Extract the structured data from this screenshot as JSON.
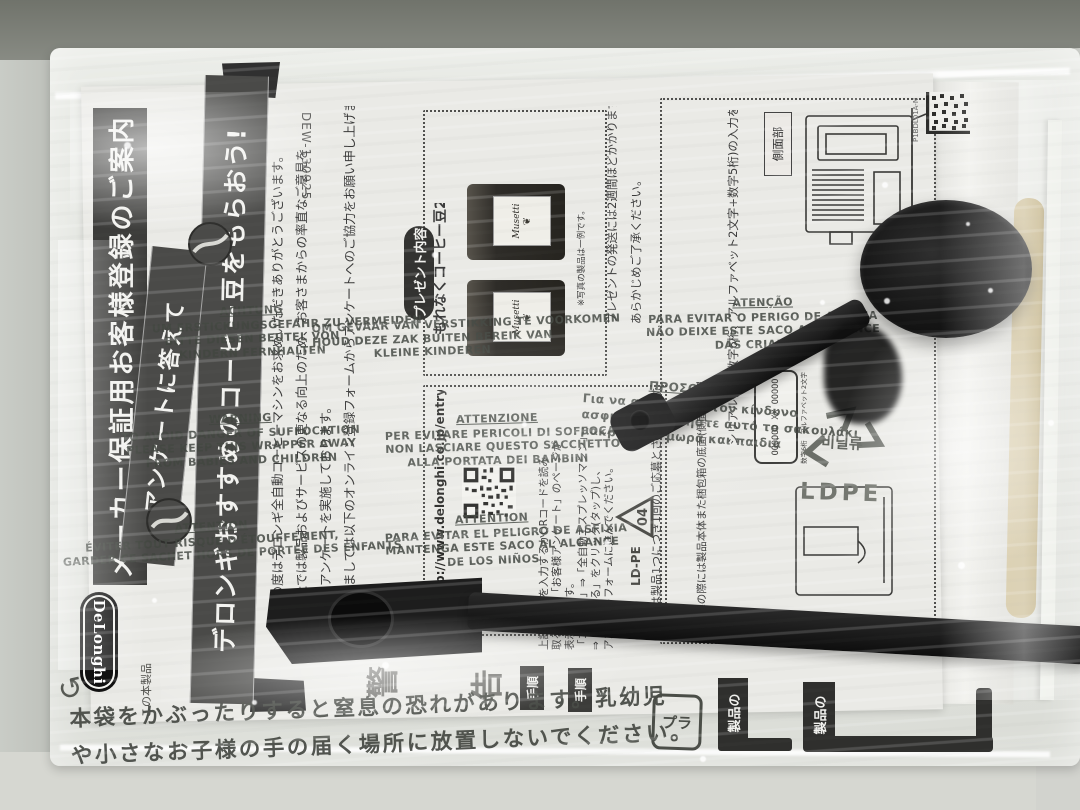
{
  "manual": {
    "title_banner": "メーカー保証用お客様登録のご案内",
    "doc_number": "DEW-130925",
    "ribbon_small": "アンケートに答えて",
    "ribbon_large": "デロンギおすすめのコーヒー豆をもらおう!",
    "logo": "DeLonghi",
    "print_code": "P1BDL01A-N",
    "intro_lines": [
      "この度はデロンギ全自動コーヒーマシンをお求めいただきありがとうございます。",
      "当社では製品およびサービスの更なる向上のため、お客さまからの率直なご意見を",
      "頂くアンケートを実施しております。",
      "つきましては以下のオンライン登録フォームからアンケートへのご協力をお願い申し上げます。"
    ],
    "campaign_note_lines": [
      "プレゼントの発送には2週間ほどかかりますので、",
      "あらかじめご了承ください。"
    ],
    "present": {
      "header": "プレゼント内容",
      "caption": "もれなくコーヒー豆2袋",
      "note": "※写真の製品は一例です。",
      "brand": "Musetti"
    },
    "entry": {
      "url": "http://www.delonghi.co.jp/entry",
      "instruction_lines": [
        "上記のURLを入力するかQRコードを読み",
        "取ることで「お客様アンケート」のページが",
        "表示されます。",
        "「コーヒー」⇒「全自動エスプレッソマシン」",
        "⇒「回答する」をクリック(タップ)し、",
        "アンケートフォームに進んでください。"
      ]
    },
    "serial": {
      "instruction": "シリアル番号(数字6桁、アルファベット2文字+数字5桁)の入力をお願いいたします。",
      "note1": "ご応募は製品1つにつき1回のご応募とさせていただきます。",
      "note2": "※応募の際には製品本体また梱包箱の底面(側面)に記載されている",
      "plate": "OOOOOO XX OOOOO",
      "label_digits": "数字6桁",
      "label_alpha": "アルファベット2文字",
      "side_label": "側面部"
    },
    "warning_header_chars": [
      "警",
      "告"
    ],
    "step_tab": "手順",
    "section_tab": "製品の",
    "bottom_note": "この本製品"
  },
  "bag": {
    "warnings": [
      {
        "title": "ACHTUNG",
        "lines": [
          "UM ERSTICKUNGSGEFAHR ZU VERMEIDEN",
          "BITTE DIESEN BEUTEL VON",
          "KINDERN FERNHALTEN"
        ]
      },
      {
        "title": "",
        "lines": [
          "OM GEVAAR VAN VERSTIKKING TE VOORKOMEN",
          "HOUD DEZE ZAK BUITEN BEREIK VAN",
          "KLEINE KINDEREN"
        ]
      },
      {
        "title": "ATENÇÃO",
        "lines": [
          "PARA EVITAR O PERIGO DE ASFIXIA",
          "NÃO DEIXE ESTE SACO AO ALCANCE",
          "DAS CRIANÇAS"
        ]
      },
      {
        "title": "WARNING",
        "lines": [
          "TO AVOID DANGER OF SUFFOCATION",
          "PLEASE KEEP THIS WRAPPER AWAY",
          "FROM BABIES AND CHILDREN"
        ]
      },
      {
        "title": "ATTENZIONE",
        "lines": [
          "PER EVITARE PERICOLI DI SOFFOCAMENTO",
          "NON LASCIARE QUESTO SACCHETTO",
          "ALLA PORTATA DEI BAMBINI"
        ]
      },
      {
        "title": "ΠΡΟΣΟΧΗ",
        "lines": [
          "Για να αποφύγετε τον κίνδυνο",
          "ασφυξίας κρατήστε αυτό το σακουλάκι",
          "μακριά από μωρά και παιδιά"
        ]
      },
      {
        "title": "ATTENTION",
        "lines": [
          "ÉVITER TOUT RISQUE D'ÉTOUFFEMENT,",
          "GARDER CE SACHET HORS DE PORTÉE DES ENFANTS"
        ]
      },
      {
        "title": "ATTENTION",
        "lines": [
          "PARA EVITAR EL PELIGRO DE ASFIXIA",
          "MANTENGA ESTE SACO AL ALCANCE",
          "DE LOS NIÑOS"
        ]
      }
    ],
    "jp_lines": [
      "本袋をかぶったりすると窒息の恐れがあります。乳幼児",
      "や小さなお子様の手の届く場所に放置しないでください。"
    ],
    "recycle": {
      "code": "04",
      "material": "LD-PE",
      "ldpe": "LDPE",
      "hdpe": "HDPE",
      "korean": "비닐류",
      "pla": "プラ"
    }
  },
  "colors": {
    "banner_dark": "#3c3c3a",
    "paper": "#eaeae6",
    "desk_dark": "#7a7d75",
    "desk_light": "#d6d7d1",
    "tool_black": "#161616",
    "booklet_tan": "#c9b98e"
  }
}
